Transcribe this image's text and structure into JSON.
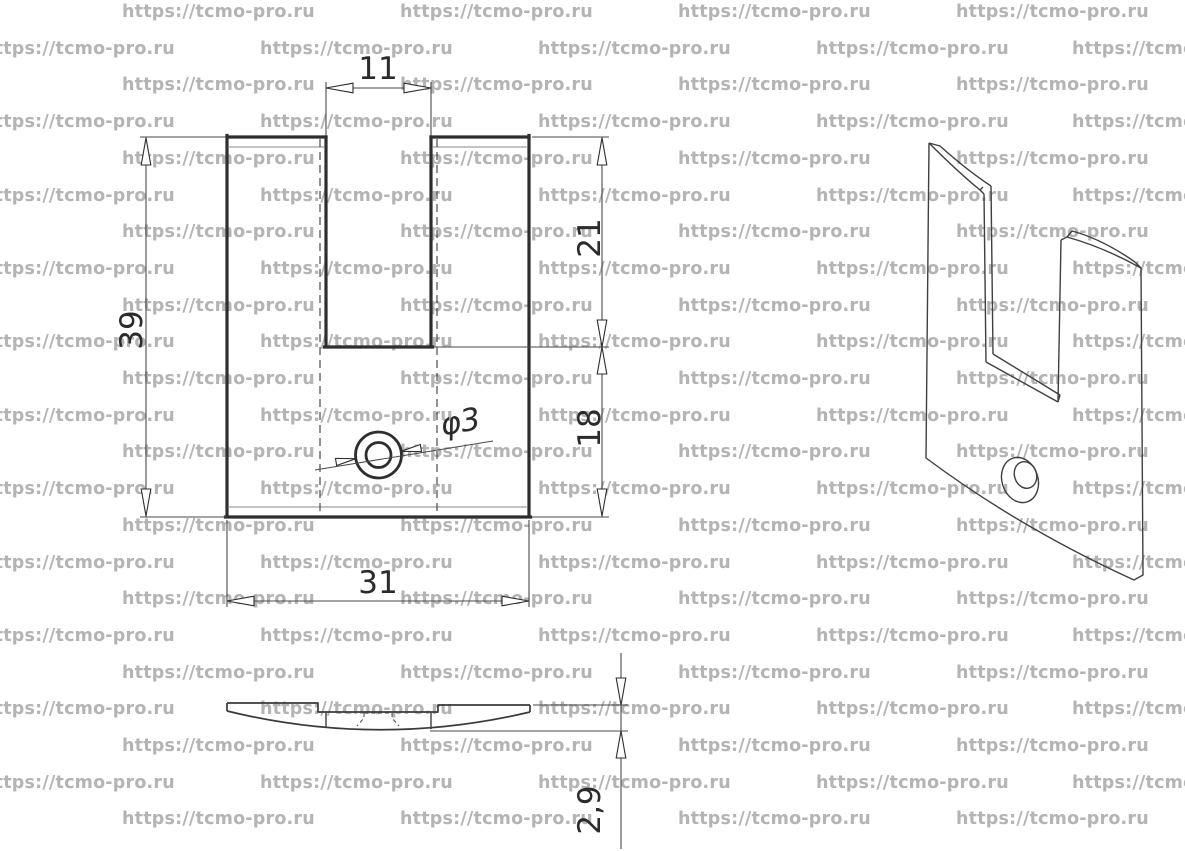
{
  "watermark": {
    "text": "https://tcmo-pro.ru",
    "color": "#b4b4b4"
  },
  "drawing": {
    "type": "technical-drawing",
    "part": "curved bracket plate with U-slot and countersunk hole",
    "labels": {
      "slot_width": "11",
      "overall_height": "39",
      "slot_depth": "21",
      "below_slot_height": "18",
      "overall_width": "31",
      "hole_diameter": "φ3",
      "thickness": "2,9"
    }
  },
  "colors": {
    "background": "#ffffff",
    "line": "#2e2e2e",
    "watermark": "#b4b4b4"
  }
}
